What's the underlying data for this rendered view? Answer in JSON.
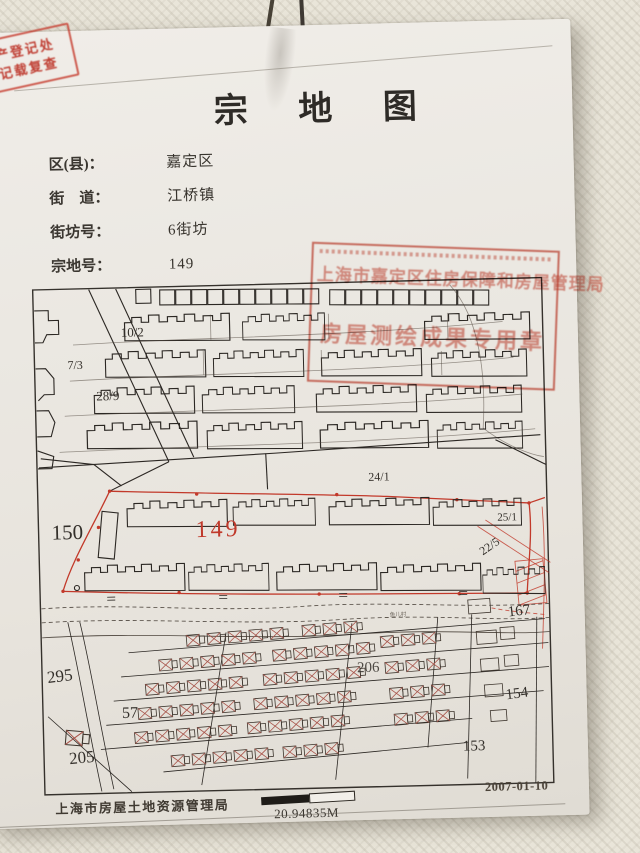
{
  "document": {
    "title": "宗 地 图",
    "fields": [
      {
        "label": "区(县)：",
        "value": "嘉定区"
      },
      {
        "label": "街　道：",
        "value": "江桥镇"
      },
      {
        "label": "街坊号：",
        "value": "6街坊"
      },
      {
        "label": "宗地号：",
        "value": "149"
      }
    ],
    "footer": {
      "agency": "上海市房屋土地资源管理局",
      "scale_text": "20.94835M",
      "date": "2007-01-10"
    }
  },
  "corner_stamp": {
    "line1": "产登记处",
    "line2": "记载复查"
  },
  "seal": {
    "line1": "上海市嘉定区住房保障和房屋管理局",
    "line2": "房屋测绘成果专用章"
  },
  "map": {
    "subject_parcel": "149",
    "labels": {
      "lot_10_2": "10/2",
      "lot_7_3": "7/3",
      "lot_28_9": "28/9",
      "road_24_1": "24/1",
      "lot_150": "150",
      "lot_149": "149",
      "lot_25_1": "25/1",
      "lot_22_5": "22/5",
      "lot_167": "167",
      "lot_295": "295",
      "lot_57": "57",
      "lot_205": "205",
      "lot_206": "206",
      "lot_153": "153",
      "lot_154": "154",
      "village": "鱼儿村"
    }
  }
}
